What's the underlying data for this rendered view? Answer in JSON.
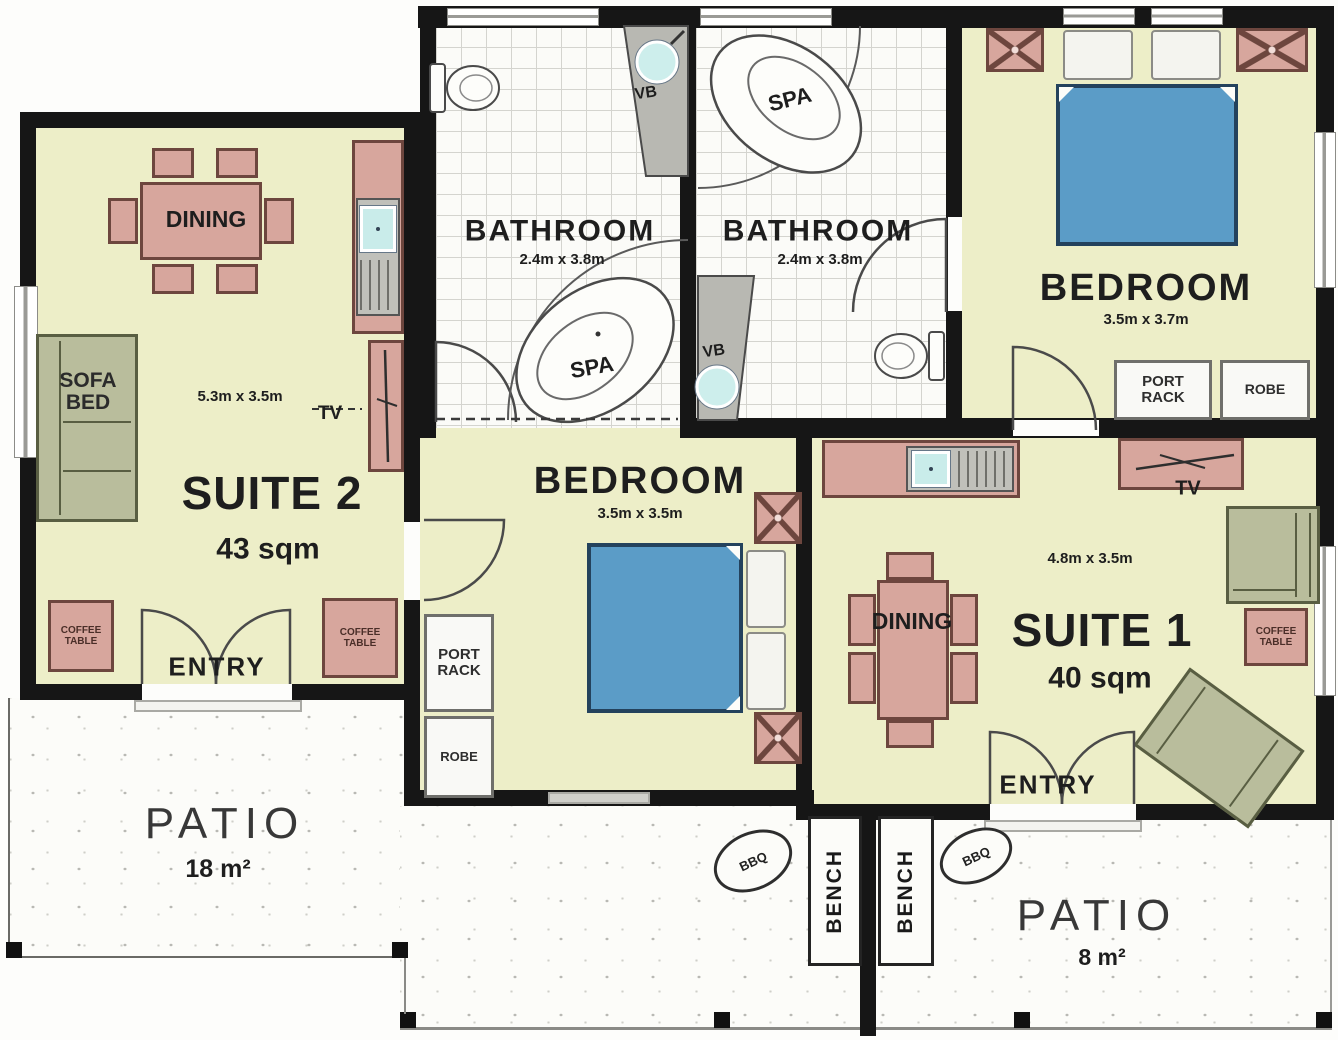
{
  "rooms": {
    "suite2": {
      "name": "SUITE 2",
      "area": "43 sqm",
      "dims": "5.3m x 3.5m"
    },
    "bathroom1": {
      "name": "BATHROOM",
      "dims": "2.4m x 3.8m"
    },
    "bathroom2": {
      "name": "BATHROOM",
      "dims": "2.4m x 3.8m"
    },
    "bedroom1": {
      "name": "BEDROOM",
      "dims": "3.5m x 3.7m"
    },
    "bedroom2": {
      "name": "BEDROOM",
      "dims": "3.5m x 3.5m"
    },
    "suite1": {
      "name": "SUITE 1",
      "area": "40 sqm",
      "dims": "4.8m x 3.5m"
    },
    "patio_left": {
      "name": "PATIO",
      "area": "18 m²"
    },
    "patio_right": {
      "name": "PATIO",
      "area": "8 m²"
    }
  },
  "fixtures": {
    "dining": "DINING",
    "sofa_bed": "SOFA BED",
    "tv": "TV",
    "coffee_table": "COFFEE TABLE",
    "port_rack": "PORT RACK",
    "robe": "ROBE",
    "spa": "SPA",
    "vanity_basin": "VB",
    "entry": "ENTRY",
    "bbq": "BBQ",
    "bench": "BENCH"
  },
  "colors": {
    "wall": "#161616",
    "floor": "#edeec8",
    "furniture_pink": "#d7a69d",
    "furniture_green": "#b9bd9c",
    "bed_blue": "#5b9cc7",
    "basin_cyan": "#cdeeec"
  }
}
